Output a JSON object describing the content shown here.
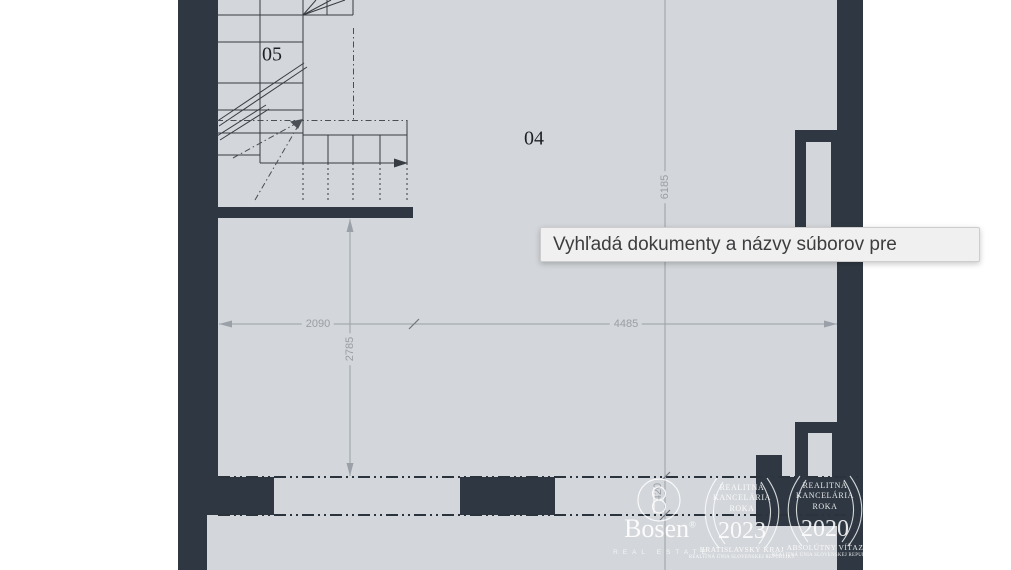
{
  "colors": {
    "wall": "#2f3842",
    "floor": "#d3d6da",
    "dimension": "#9aa0a7",
    "tooltip_bg": "#f0f0f1",
    "watermark": "#ffffff"
  },
  "plan": {
    "rooms": [
      {
        "label": "05"
      },
      {
        "label": "04"
      }
    ],
    "dimensions": {
      "width_left": "2090",
      "width_right": "4485",
      "height_left": "2785",
      "height_right": "6185",
      "wall_gap": "420"
    }
  },
  "tooltip": {
    "text": "Vyhľadá dokumenty a názvy súborov pre"
  },
  "watermark": {
    "brand": "Bosen",
    "brand_reg": "®",
    "brand_sub": "REAL ESTATE",
    "badges": [
      {
        "line1": "REALITNÁ",
        "line2": "KANCELÁRIA",
        "line3": "ROKA",
        "year": "2023",
        "award": "BRATISLAVSKÝ KRAJ",
        "org": "REALITNÁ ÚNIA SLOVENSKEJ REPUBLIKY"
      },
      {
        "line1": "REALITNÁ",
        "line2": "KANCELÁRIA",
        "line3": "ROKA",
        "year": "2020",
        "award": "ABSOLÚTNY VÍŤAZ",
        "org": "REALITNÁ ÚNIA SLOVENSKEJ REPUBLIKY"
      }
    ]
  }
}
